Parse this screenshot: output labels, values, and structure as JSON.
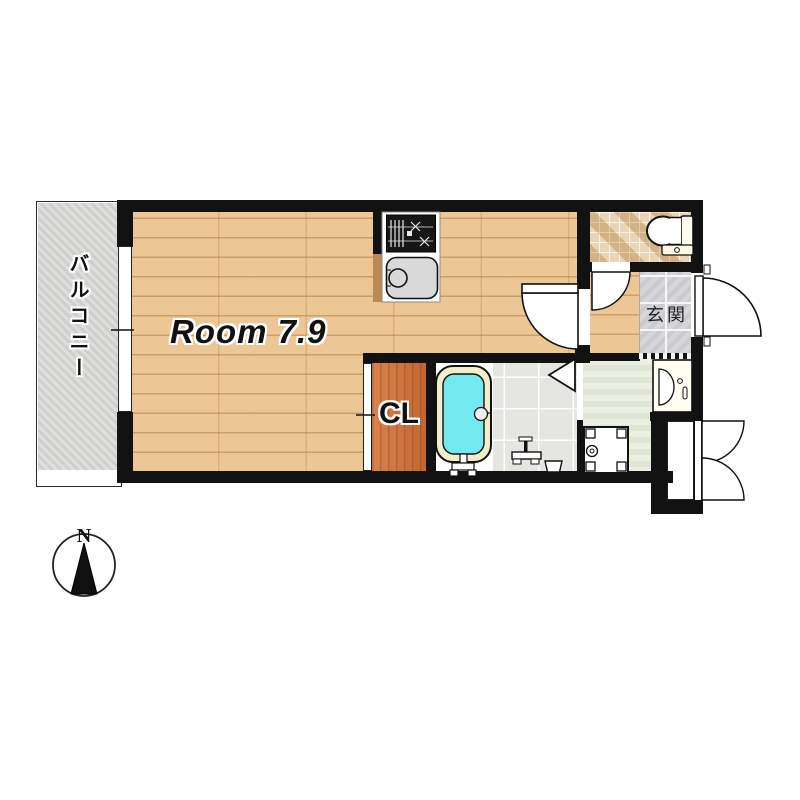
{
  "floorplan": {
    "labels": {
      "main_room": "Room 7.9",
      "closet": "CL",
      "entrance": "玄関",
      "balcony": "バルコニー",
      "compass_north": "N"
    },
    "rooms": [
      {
        "name": "main-room",
        "label": "Room 7.9",
        "floor": "wood"
      },
      {
        "name": "closet",
        "label": "CL",
        "floor": "wood-orange"
      },
      {
        "name": "kitchen",
        "label": "",
        "floor": "wood",
        "fixtures": [
          "stove-icon",
          "sink-icon"
        ]
      },
      {
        "name": "bathroom",
        "label": "",
        "floor": "tile",
        "fixtures": [
          "bathtub-icon",
          "shower-mixer-icon",
          "bucket-icon"
        ]
      },
      {
        "name": "toilet-room",
        "label": "",
        "floor": "mosaic-tile",
        "fixtures": [
          "toilet-icon"
        ]
      },
      {
        "name": "entrance",
        "label": "玄関",
        "floor": "stone-tile"
      },
      {
        "name": "washroom",
        "label": "",
        "floor": "green",
        "fixtures": [
          "washbasin-icon",
          "washer-pan-icon"
        ]
      },
      {
        "name": "balcony",
        "label": "バルコニー",
        "floor": "concrete"
      },
      {
        "name": "storage",
        "label": "",
        "floor": "white",
        "fixtures": [
          "double-door"
        ]
      }
    ],
    "compass": {
      "direction": "N",
      "arrow": "up"
    },
    "colors": {
      "wall": "#121212",
      "wood_floor": "#ecc795",
      "wood_plank_line": "#ab763c",
      "closet_floor": "#d0713a",
      "balcony_floor": "#d3d3d1",
      "toilet_tile": "#e4cba6",
      "entrance_tile": "#d6d6d9",
      "washroom_floor": "#e3ead9",
      "bathroom_floor": "#e5e5e1",
      "bathtub_rim": "#f2eec9",
      "bath_water": "#72e9ee",
      "sink": "#d9d9d9"
    }
  }
}
